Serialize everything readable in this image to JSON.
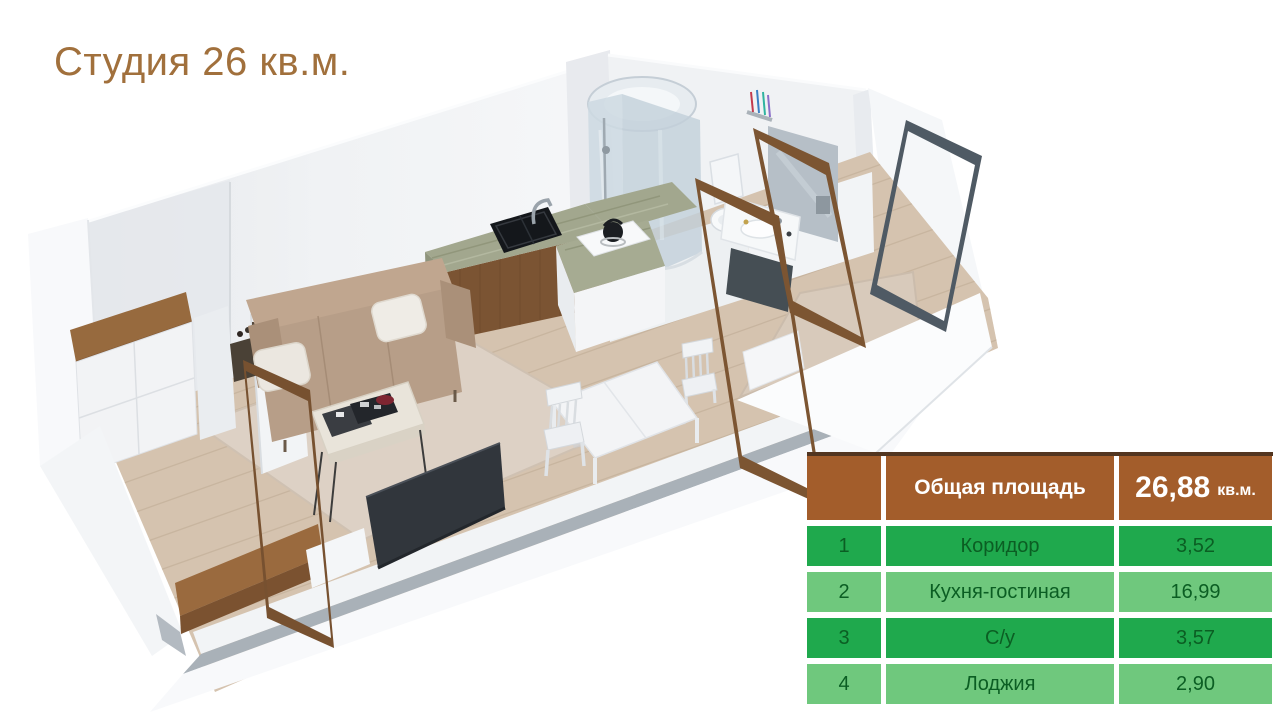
{
  "title": "Студия 26 кв.м.",
  "table": {
    "header": {
      "label": "Общая площадь",
      "value": "26,88",
      "unit": "кв.м."
    },
    "rows": [
      {
        "num": "1",
        "name": "Коридор",
        "area": "3,52"
      },
      {
        "num": "2",
        "name": "Кухня-гостиная",
        "area": "16,99"
      },
      {
        "num": "3",
        "name": "С/у",
        "area": "3,57"
      },
      {
        "num": "4",
        "name": "Лоджия",
        "area": "2,90"
      }
    ]
  },
  "colors": {
    "title_text": "#a1703c",
    "table_header_bg": "#a35d2b",
    "table_header_text": "#ffffff",
    "table_top_border": "#523520",
    "table_row_dark_green": "#1fa94d",
    "table_row_light_green": "#6fc87d",
    "table_row_text": "#0b5e23",
    "wall_light": "#f2f4f6",
    "wall_shadow": "#a9b1b8",
    "floor_wood": "#d5c3af",
    "cabinet_wood": "#7b5433",
    "door_frame_wood": "#7c5532",
    "loggia_frame": "#4f5a64",
    "sofa": "#b79e88",
    "tv": "#31363c",
    "marble_counter": "#a2a78e"
  },
  "floorplan": {
    "style": "3d-isometric-render",
    "furniture": [
      "wardrobe",
      "sofa",
      "pillows",
      "side-table",
      "coffee-table",
      "magazines",
      "red-bowl",
      "tv",
      "living-rug",
      "kitchen-counter",
      "kitchen-sink",
      "faucet",
      "kitchen-island",
      "kettle",
      "dining-table",
      "dining-chairs",
      "shower-cabin",
      "toilet",
      "washbasin",
      "vanity-mirror",
      "toothbrushes",
      "doorway-frames",
      "loggia-door-frame",
      "loggia-rug"
    ]
  }
}
